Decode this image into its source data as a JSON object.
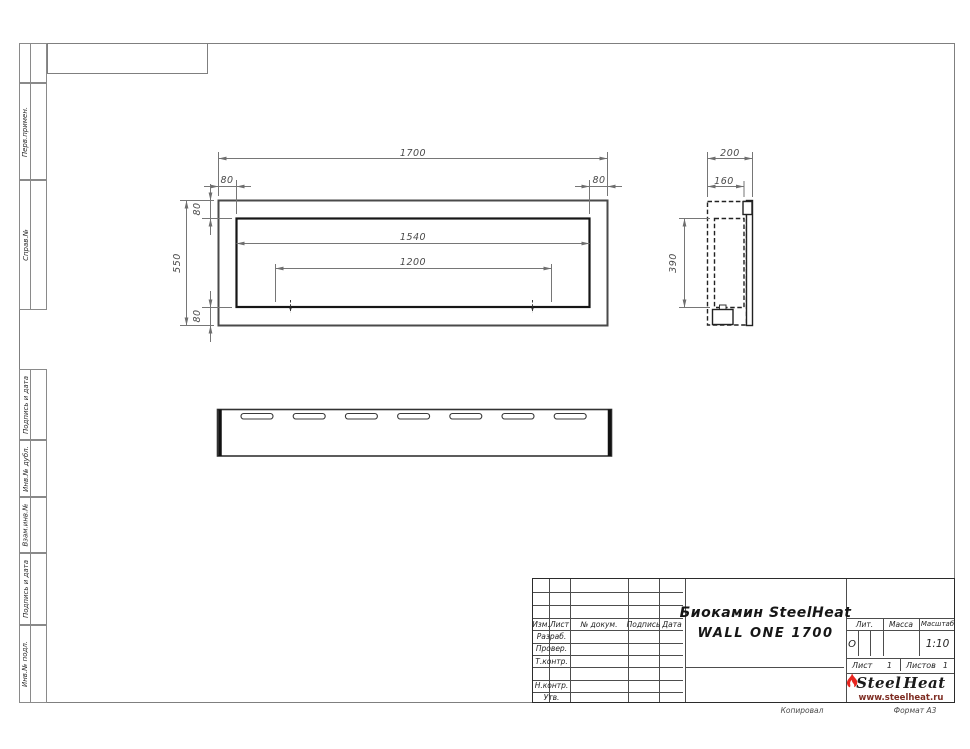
{
  "colors": {
    "flame_red": "#e8251f",
    "logo_url_text": "#7e2d23",
    "frame_line": "#7f7f7f",
    "object_line": "#262626",
    "dimension_line": "#767676"
  },
  "sidebar": {
    "items": [
      "Перв.примен.",
      "Справ.№",
      "Подпись и дата",
      "Инв.№ дубл.",
      "Взам.инв.№",
      "Подпись и дата",
      "Инв.№ подл."
    ]
  },
  "dimensions": {
    "front": {
      "width": "1700",
      "left_offset": "80",
      "right_offset": "80",
      "top_offset": "80",
      "bottom_offset": "80",
      "height": "550",
      "opening": "1540",
      "burner": "1200"
    },
    "side": {
      "depth": "200",
      "inner_depth": "160",
      "height": "390"
    }
  },
  "title_block": {
    "revision_headers": [
      "Изм.",
      "Лист",
      "№ докум.",
      "Подпись",
      "Дата"
    ],
    "signature_rows": [
      "Разраб.",
      "Провер.",
      "Т.контр.",
      "",
      "Н.контр.",
      "Утв."
    ],
    "title_line1": "Биокамин SteelHeat",
    "title_line2": "WALL ONE 1700",
    "lit_label": "Лит.",
    "lit_value": "О",
    "mass_label": "Масса",
    "scale_label": "Масштаб",
    "scale_value": "1:10",
    "sheet_label": "Лист",
    "sheet_number": "1",
    "sheets_label": "Листов",
    "sheets_total": "1",
    "logo": {
      "part1": "Steel",
      "part2": "Heat",
      "url": "www.steelheat.ru"
    }
  },
  "footer": {
    "copied_by": "Копировал",
    "format": "Формат А3"
  }
}
